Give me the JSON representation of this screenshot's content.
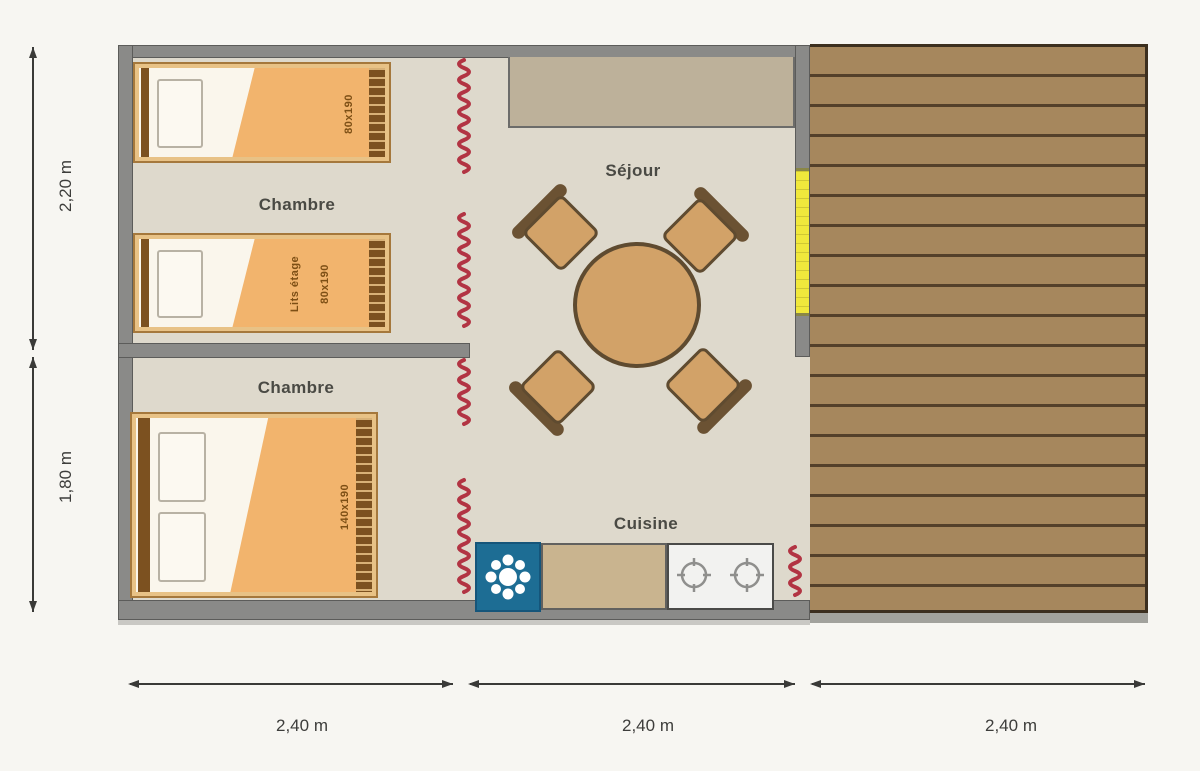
{
  "rooms": {
    "chambre_top": "Chambre",
    "chambre_bottom": "Chambre",
    "sejour": "Séjour",
    "cuisine": "Cuisine"
  },
  "beds": {
    "single": {
      "size": "80x190"
    },
    "bunk": {
      "label": "Lits étage",
      "size": "80x190"
    },
    "double": {
      "size": "140x190"
    }
  },
  "dimensions": {
    "vertical": [
      {
        "label": "2,20 m"
      },
      {
        "label": "1,80 m"
      }
    ],
    "horizontal": [
      {
        "label": "2,40 m"
      },
      {
        "label": "2,40 m"
      },
      {
        "label": "2,40 m"
      }
    ]
  },
  "icons": {
    "fridge": "snowflake-icon",
    "stove": "gas-burner-icon"
  },
  "colors": {
    "floor": "#ded9cc",
    "wall": "#8a8a88",
    "deck": "#a6875d",
    "deck_line": "#54402a",
    "canvas_wall_red": "#b23443",
    "door_yellow": "#f0e83c",
    "bed_blanket": "#f2b46d",
    "bed_frame": "#e8c286",
    "wood_dark": "#7c5120",
    "table": "#d2a268",
    "chair_back": "#6b5233",
    "fridge_blue": "#1d6d94",
    "counter": "#c9b48f",
    "dimension": "#3a3a38"
  }
}
